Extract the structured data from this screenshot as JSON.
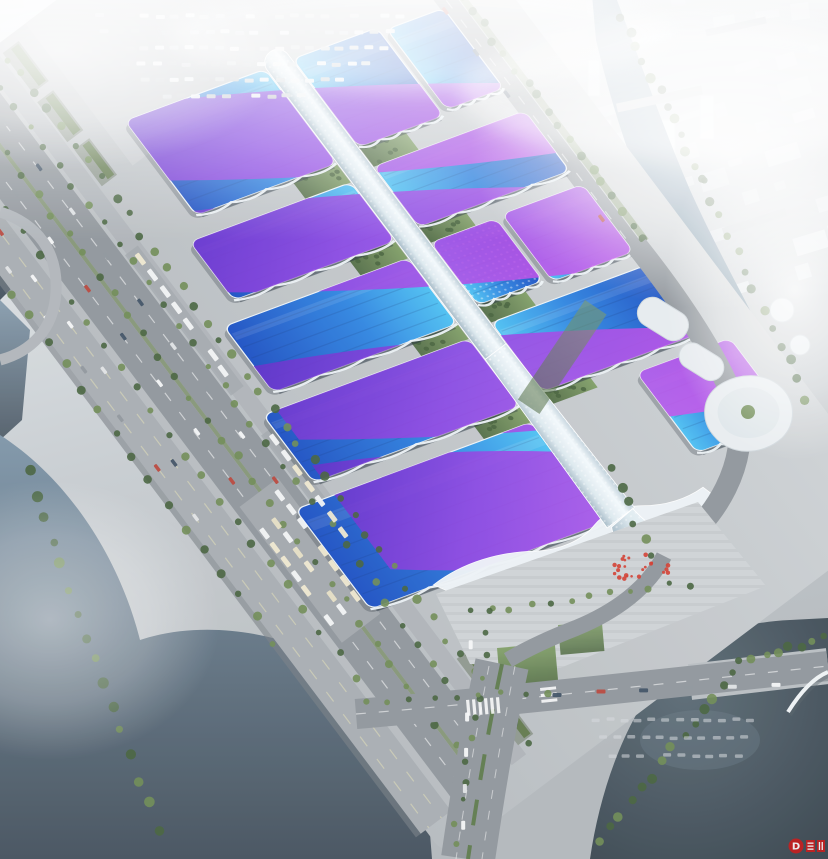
{
  "meta": {
    "title": "Aerial rendering of exhibition and convention center",
    "description": "Bird's-eye architectural rendering of a large exhibition convention center: rows of wavy blue roofs with purple ribbon stripes on both sides of a long white central concourse spine, surrounded by roads, parking lots, rivers, lakes and a hazy white city skyline"
  },
  "scene": {
    "labels": {
      "complex": "exhibition-center-complex",
      "spine": "central-concourse-spine",
      "entrance": "south-entrance-wave-hall",
      "plaza": "south-entrance-plaza",
      "city": "hazy-city-backdrop",
      "water_left": "west-river",
      "water_right": "east-river",
      "lake": "southeast-lake"
    },
    "colors": {
      "roof_blue_light": "#4cc0f2",
      "roof_blue": "#2e84e0",
      "roof_blue_deep": "#1b4fc2",
      "ribbon_purple": "#5f2ac8",
      "ribbon_magenta": "#c653ea",
      "spine_white": "#f3f9fc",
      "ground": "#c7ccd0",
      "road": "#8f959b",
      "road_light": "#aeb3b8",
      "water_dark": "#36424c",
      "water_mid": "#5f7a8e",
      "water_light": "#93abbe",
      "green_dark": "#44603b",
      "green_light": "#6d8a52",
      "city_white": "#e6ebef",
      "fog": "#ffffff",
      "plaza": "#ced2d5",
      "red_accent": "#d23a2e",
      "watermark_red": "#c81f1f"
    },
    "city_clusters": [
      {
        "x0": -20,
        "y0": -6,
        "cols": 21,
        "rows": 5,
        "dx": 40,
        "dy": 27,
        "rot": -7,
        "bw": 30,
        "bh": 14
      },
      {
        "x0": 560,
        "y0": 118,
        "cols": 8,
        "rows": 8,
        "dx": 36,
        "dy": 30,
        "rot": -17,
        "bw": 26,
        "bh": 13
      },
      {
        "x0": 10,
        "y0": 120,
        "cols": 4,
        "rows": 3,
        "dx": 36,
        "dy": 28,
        "rot": -7,
        "bw": 24,
        "bh": 12
      }
    ],
    "halls": [
      {
        "id": "hall-L1",
        "x": -30,
        "y": 14,
        "w": 118,
        "h": 143,
        "side": "L"
      },
      {
        "id": "hall-L2",
        "x": 112,
        "y": 14,
        "w": 73,
        "h": 164,
        "side": "L"
      },
      {
        "id": "hall-L3",
        "x": 207,
        "y": 14,
        "w": 82,
        "h": 188,
        "side": "L"
      },
      {
        "id": "hall-L4",
        "x": 308,
        "y": 14,
        "w": 84,
        "h": 210,
        "side": "L"
      },
      {
        "id": "hall-L5",
        "x": 412,
        "y": 14,
        "w": 125,
        "h": 241,
        "side": "L"
      },
      {
        "id": "hall-R1a",
        "x": -30,
        "y": -100,
        "w": 110,
        "h": 86,
        "side": "R"
      },
      {
        "id": "hall-R1b",
        "x": -25,
        "y": -165,
        "w": 100,
        "h": 58,
        "side": "R"
      },
      {
        "id": "hall-R2",
        "x": 105,
        "y": -168,
        "w": 75,
        "h": 154,
        "side": "R"
      },
      {
        "id": "hall-R3a",
        "x": 200,
        "y": -80,
        "w": 78,
        "h": 66,
        "side": "R",
        "dotted": true
      },
      {
        "id": "hall-R3b",
        "x": 198,
        "y": -170,
        "w": 84,
        "h": 82,
        "side": "R"
      },
      {
        "id": "hall-R4",
        "x": 300,
        "y": -172,
        "w": 86,
        "h": 158,
        "side": "R"
      },
      {
        "id": "hall-R5",
        "x": 402,
        "y": -195,
        "w": 100,
        "h": 95,
        "side": "R"
      }
    ],
    "ribbons": [
      {
        "pts": [
          -60,
          210,
          20,
          210,
          165,
          -200,
          85,
          -200
        ]
      },
      {
        "pts": [
          70,
          210,
          160,
          210,
          305,
          -200,
          215,
          -200
        ]
      },
      {
        "pts": [
          255,
          210,
          345,
          210,
          480,
          -200,
          390,
          -200
        ]
      },
      {
        "pts": [
          375,
          215,
          505,
          215,
          600,
          -70,
          495,
          -70
        ]
      }
    ],
    "green_gaps": [
      [
        88,
        14,
        24,
        46
      ],
      [
        185,
        14,
        22,
        48
      ],
      [
        289,
        14,
        19,
        48
      ],
      [
        392,
        14,
        20,
        48
      ],
      [
        80,
        -60,
        25,
        46
      ],
      [
        180,
        -60,
        20,
        46
      ],
      [
        278,
        -60,
        22,
        46
      ],
      [
        386,
        -60,
        16,
        46
      ]
    ],
    "tree_lines": [
      {
        "frame": "rot",
        "x1": -330,
        "y1": 212,
        "x2": 660,
        "y2": 212,
        "n": 46,
        "r": 3.8
      },
      {
        "frame": "rot",
        "x1": -330,
        "y1": 237,
        "x2": 640,
        "y2": 237,
        "n": 40,
        "r": 3.4
      },
      {
        "frame": "rot",
        "x1": -330,
        "y1": 271,
        "x2": 620,
        "y2": 271,
        "n": 38,
        "r": 3.4
      },
      {
        "frame": "rot",
        "x1": -300,
        "y1": 308,
        "x2": 560,
        "y2": 308,
        "n": 32,
        "r": 3.6
      },
      {
        "frame": "rot",
        "x1": -240,
        "y1": 352,
        "x2": 430,
        "y2": 352,
        "n": 24,
        "r": 3.8
      },
      {
        "frame": "rot",
        "x1": -80,
        "y1": -186,
        "x2": 330,
        "y2": -186,
        "n": 24,
        "r": 3.8
      },
      {
        "frame": "abs",
        "x1": 622,
        "y1": 15,
        "x2": 702,
        "y2": 182,
        "n": 12,
        "r": 4.2
      },
      {
        "frame": "abs",
        "x1": 702,
        "y1": 182,
        "x2": 806,
        "y2": 398,
        "n": 13,
        "r": 4.2
      },
      {
        "frame": "abs",
        "x1": 470,
        "y1": 612,
        "x2": 688,
        "y2": 584,
        "n": 12,
        "r": 3
      },
      {
        "frame": "abs",
        "x1": 492,
        "y1": 614,
        "x2": 454,
        "y2": 843,
        "n": 12,
        "r": 3
      },
      {
        "frame": "abs",
        "x1": 598,
        "y1": 842,
        "x2": 736,
        "y2": 670,
        "n": 14,
        "r": 4.2
      },
      {
        "frame": "abs",
        "x1": 742,
        "y1": 662,
        "x2": 824,
        "y2": 638,
        "n": 8,
        "r": 4
      },
      {
        "frame": "abs",
        "x1": 28,
        "y1": 470,
        "x2": 156,
        "y2": 828,
        "n": 16,
        "r": 4.5
      },
      {
        "frame": "abs",
        "x1": 366,
        "y1": 704,
        "x2": 545,
        "y2": 692,
        "n": 9,
        "r": 3.2
      },
      {
        "frame": "abs",
        "x1": 612,
        "y1": 470,
        "x2": 652,
        "y2": 556,
        "n": 6,
        "r": 4
      }
    ],
    "vehicle_rows": [
      {
        "frame": "abs",
        "x": 95,
        "y": 14,
        "dx": 15,
        "dy": 0,
        "n": 21,
        "w": 9,
        "h": 4,
        "kind": "parked"
      },
      {
        "frame": "abs",
        "x": 100,
        "y": 30,
        "dx": 15,
        "dy": 0,
        "n": 20,
        "w": 9,
        "h": 4,
        "kind": "parked"
      },
      {
        "frame": "abs",
        "x": 110,
        "y": 46,
        "dx": 15,
        "dy": 0,
        "n": 19,
        "w": 9,
        "h": 4,
        "kind": "parked"
      },
      {
        "frame": "abs",
        "x": 122,
        "y": 62,
        "dx": 15,
        "dy": 0,
        "n": 17,
        "w": 9,
        "h": 4,
        "kind": "parked"
      },
      {
        "frame": "abs",
        "x": 140,
        "y": 78,
        "dx": 15,
        "dy": 0,
        "n": 15,
        "w": 9,
        "h": 4,
        "kind": "parked"
      },
      {
        "frame": "abs",
        "x": 162,
        "y": 94,
        "dx": 15,
        "dy": 0,
        "n": 11,
        "w": 9,
        "h": 4,
        "kind": "parked"
      },
      {
        "frame": "rot",
        "x": 36,
        "y": 226,
        "dx": 20,
        "dy": 0,
        "n": 8,
        "w": 13,
        "h": 5,
        "kind": "bus"
      },
      {
        "frame": "rot",
        "x": 262,
        "y": 228,
        "dx": 19,
        "dy": 0,
        "n": 7,
        "w": 12,
        "h": 5,
        "kind": "bus"
      },
      {
        "frame": "rot",
        "x": 308,
        "y": 256,
        "dx": 18,
        "dy": 0,
        "n": 8,
        "w": 12,
        "h": 5,
        "kind": "bus"
      },
      {
        "frame": "rot",
        "x": 312,
        "y": 276,
        "dx": 18,
        "dy": 0,
        "n": 8,
        "w": 12,
        "h": 5,
        "kind": "bus"
      },
      {
        "frame": "rot",
        "x": 330,
        "y": 292,
        "dx": 18,
        "dy": 0,
        "n": 7,
        "w": 12,
        "h": 5,
        "kind": "bus"
      },
      {
        "frame": "rot",
        "x": -320,
        "y": 252,
        "dx": 56,
        "dy": 0,
        "n": 12,
        "w": 8,
        "h": 3.5,
        "kind": "cars"
      },
      {
        "frame": "rot",
        "x": -330,
        "y": 286,
        "dx": 60,
        "dy": 0,
        "n": 11,
        "w": 8,
        "h": 3.5,
        "kind": "cars"
      },
      {
        "frame": "rot",
        "x": -300,
        "y": 322,
        "dx": 58,
        "dy": 0,
        "n": 11,
        "w": 8,
        "h": 3.5,
        "kind": "cars"
      },
      {
        "frame": "rot",
        "x": -280,
        "y": 338,
        "dx": 62,
        "dy": 0,
        "n": 10,
        "w": 8,
        "h": 3.5,
        "kind": "cars"
      },
      {
        "frame": "rot",
        "x": -80,
        "y": -166,
        "dx": 52,
        "dy": 0,
        "n": 8,
        "w": 8,
        "h": 3.5,
        "kind": "cars"
      },
      {
        "frame": "abs",
        "x": 592,
        "y": 718,
        "dx": 14,
        "dy": 0,
        "n": 12,
        "w": 8,
        "h": 3.5,
        "kind": "faint"
      },
      {
        "frame": "abs",
        "x": 600,
        "y": 736,
        "dx": 14,
        "dy": 0,
        "n": 11,
        "w": 8,
        "h": 3.5,
        "kind": "faint"
      },
      {
        "frame": "abs",
        "x": 608,
        "y": 754,
        "dx": 14,
        "dy": 0,
        "n": 10,
        "w": 8,
        "h": 3.5,
        "kind": "faint"
      },
      {
        "frame": "abs",
        "x": 468,
        "y": 640,
        "dx": -1.5,
        "dy": 36,
        "n": 6,
        "w": 4,
        "h": 9,
        "kind": "cars"
      },
      {
        "frame": "abs",
        "x": 552,
        "y": 692,
        "dx": 44,
        "dy": -2,
        "n": 6,
        "w": 9,
        "h": 4,
        "kind": "cars"
      }
    ],
    "red_cluster": {
      "cx": 638,
      "cy": 566,
      "rx": 34,
      "ry": 15,
      "n": 24
    }
  },
  "watermark": {
    "letter": "D"
  }
}
